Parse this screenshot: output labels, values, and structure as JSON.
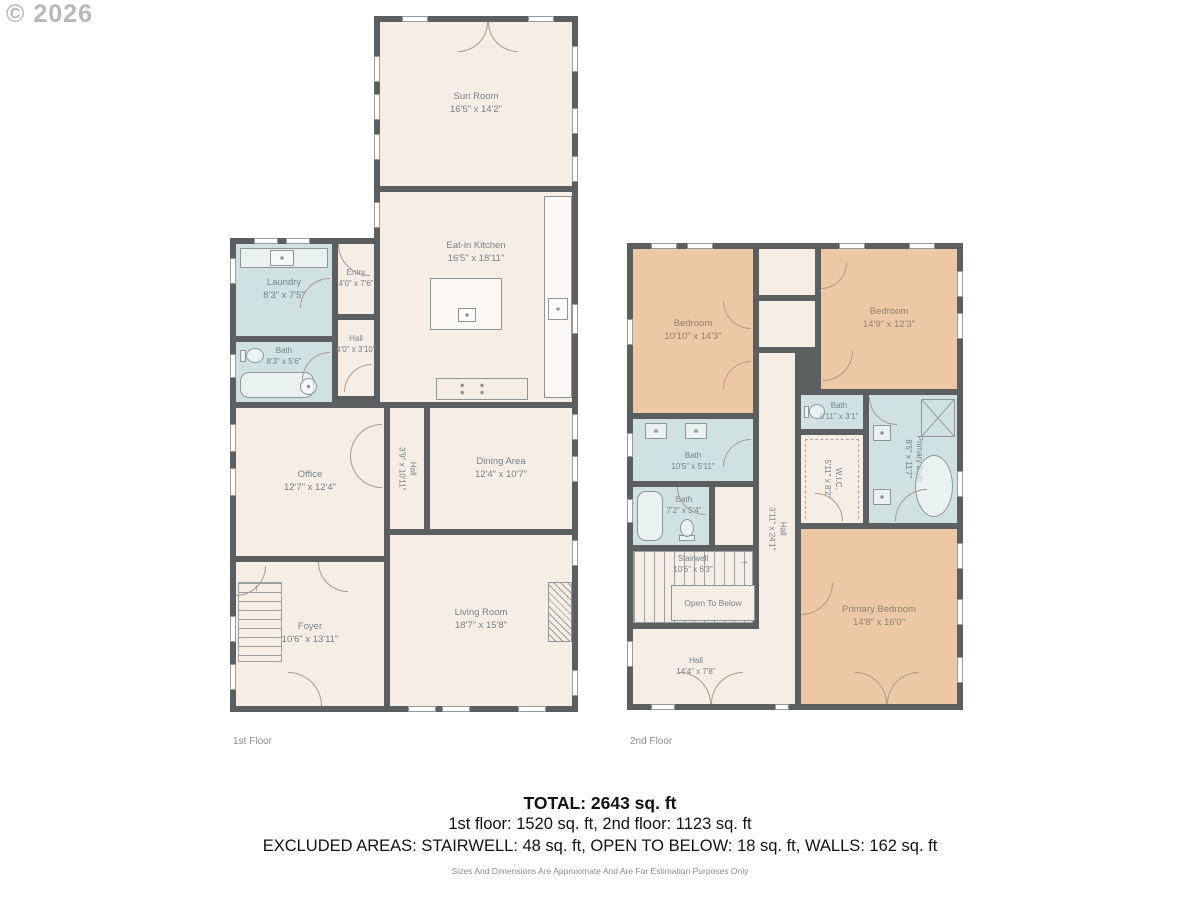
{
  "watermark": "© 2026",
  "floors": [
    {
      "label": "1st Floor",
      "rooms": [
        {
          "name": "Sun Room",
          "dims": "16'5\" x 14'2\""
        },
        {
          "name": "Eat-in Kitchen",
          "dims": "16'5\" x 18'11\""
        },
        {
          "name": "Laundry",
          "dims": "8'3\" x 7'5\""
        },
        {
          "name": "Entry",
          "dims": "4'0\" x 7'6\""
        },
        {
          "name": "Bath",
          "dims": "8'3\" x 5'6\""
        },
        {
          "name": "Hall",
          "dims": "4'0\" x 3'10\""
        },
        {
          "name": "Office",
          "dims": "12'7\" x 12'4\""
        },
        {
          "name": "Hall",
          "dims": "3'9\" x 10'11\""
        },
        {
          "name": "Dining Area",
          "dims": "12'4\" x 10'7\""
        },
        {
          "name": "Living Room",
          "dims": "18'7\" x 15'8\""
        },
        {
          "name": "Foyer",
          "dims": "10'6\" x 13'11\""
        }
      ]
    },
    {
      "label": "2nd Floor",
      "rooms": [
        {
          "name": "Bedroom",
          "dims": "10'10\" x 14'3\""
        },
        {
          "name": "Bedroom",
          "dims": "14'9\" x 12'3\""
        },
        {
          "name": "Bath",
          "dims": "5'11\" x 3'1\""
        },
        {
          "name": "Primary Bath",
          "dims": "8'5\" x 11'7\""
        },
        {
          "name": "Bath",
          "dims": "10'5\" x 5'11\""
        },
        {
          "name": "Bath",
          "dims": "7'2\" x 5'4\""
        },
        {
          "name": "W.I.C.",
          "dims": "5'11\" x 8'2\""
        },
        {
          "name": "Hall",
          "dims": "3'11\" x 24'1\""
        },
        {
          "name": "Stairwell",
          "dims": "10'6\" x 6'3\""
        },
        {
          "name": "Open To Below",
          "dims": ""
        },
        {
          "name": "Hall",
          "dims": "14'4\" x 7'8\""
        },
        {
          "name": "Primary Bedroom",
          "dims": "14'8\" x 16'0\""
        }
      ]
    }
  ],
  "footer": {
    "total": "TOTAL: 2643 sq. ft",
    "floors_line": "1st floor: 1520 sq. ft, 2nd floor: 1123 sq. ft",
    "excluded_line": "EXCLUDED AREAS: STAIRWELL: 48 sq. ft, OPEN TO BELOW: 18 sq. ft, WALLS: 162 sq. ft",
    "disclaimer": "Sizes And Dimensions Are Approximate And Are For Estimation Purposes Only"
  },
  "colors": {
    "wall": "#5c5f60",
    "floor_cream": "#f6ede4",
    "floor_bath_blue": "#cfe1e1",
    "floor_bedroom_tan": "#ecc9a4",
    "label_text": "#77838c",
    "door_arc": "#ab9c8b"
  }
}
